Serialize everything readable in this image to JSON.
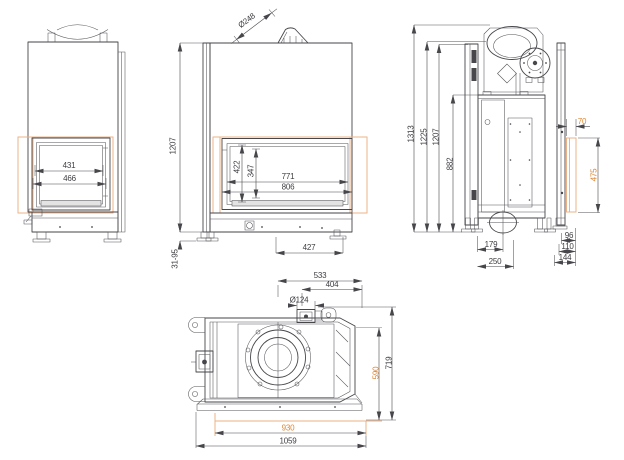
{
  "drawing": {
    "type": "technical-dimension-drawing",
    "unit": "mm",
    "colors": {
      "line": "#46464b",
      "accent_text": "#e0862f",
      "accent_line": "#edb082",
      "background": "#ffffff"
    },
    "views": {
      "side_left": "left-side-view",
      "front": "front-view",
      "side_right": "right-side-view",
      "top": "top-view"
    }
  },
  "dims": {
    "side_left": {
      "glass_width": "431",
      "frame_width": "466"
    },
    "front": {
      "flue_diameter": "Ø248",
      "height_body": "1207",
      "foot_adjust_range": "31-95",
      "glass_height": "422",
      "opening_height": "347",
      "glass_width": "771",
      "frame_width": "806",
      "base_width": "427"
    },
    "side_right": {
      "height_total": "1313",
      "height_collar": "1225",
      "height_body": "1207",
      "height_firebox": "882",
      "frame_offset": "70",
      "frame_height": "475",
      "intake_center": "179",
      "intake_edge": "250",
      "depth_frame_1": "96",
      "depth_frame_2": "110",
      "depth_frame_3": "144"
    },
    "top": {
      "flue_center_offset": "533",
      "intake_offset": "404",
      "intake_diameter": "Ø124",
      "depth_total": "719",
      "frame_depth": "590",
      "frame_width": "930",
      "width_total": "1059"
    }
  }
}
